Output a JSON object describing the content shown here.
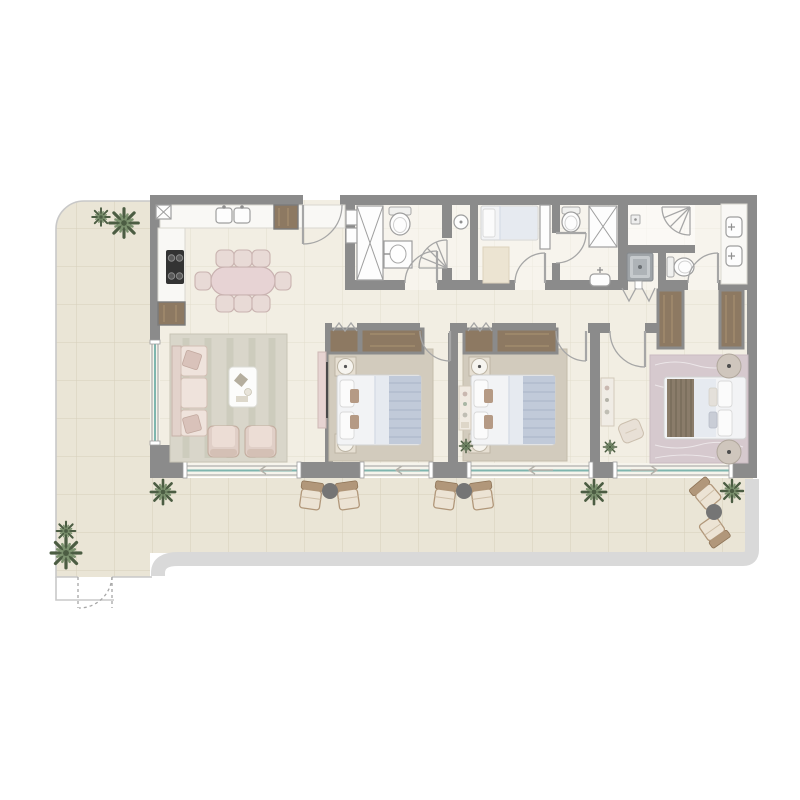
{
  "meta": {
    "title": "apartment-floor-plan",
    "canvas_width": 800,
    "canvas_height": 800
  },
  "palette": {
    "wall": "#8b8b8b",
    "white": "#ffffff",
    "floorIn": "#f2eee3",
    "floorTer": "#eae5d6",
    "gridIn": "rgba(185,175,145,0.28)",
    "gridTer": "rgba(172,162,132,0.32)",
    "band": "#d9d9d9",
    "outline": "#c8c8c8",
    "glass": "#7fb5ae",
    "arcLine": "#a6a6a6",
    "wood": "#8d7962",
    "woodGrain": "#a6906f",
    "woodFrame": "#7c7c7c",
    "fixFill": "#fdfdfd",
    "fixStroke": "#9e9e9e",
    "counter": "#f9f8f5",
    "counterStroke": "#d9d7d0",
    "appliance": "#333333",
    "pinkFill": "#e7d3d4",
    "pinkStroke": "#c9b2b1",
    "chairFill": "#e8dad6",
    "chairStroke": "#c9b3b0",
    "rugLiving": "#d9d6ca",
    "rugBed": "#d2cbbd",
    "rugMaster": "#d6c9ce",
    "mattress": "#f2f3f5",
    "mattressStroke": "#d3d3d3",
    "pillow": "#fbfbfb",
    "duvet": "#e6eaf0",
    "throw": "#c1cad9",
    "throwLine": "#a9b4c6",
    "bedBrown": "#8a7c6a",
    "bedBrownLine": "#6f6353",
    "nstand": "#e6dfd2",
    "nstandStroke": "#bdb5a5",
    "lamp": "#f6f4ef",
    "plantDark": "#4c5d43",
    "plantLight": "#7d9370",
    "outChairWood": "#b1977a",
    "outChairSeat": "#ece3d4",
    "outTable": "#757575",
    "washerA": "#9fa4a8",
    "washerB": "#c6cacd"
  },
  "inventory": {
    "double_beds": 3,
    "single_beds": 1,
    "sofas": 1,
    "armchairs": 2,
    "dining_chairs": 8,
    "toilets": 3,
    "washbasins": 5,
    "showers": 3,
    "washing_machines": 1,
    "wardrobes": 6,
    "plants": 9,
    "outdoor_chairs": 6,
    "outdoor_side_tables": 3,
    "sliding_windows": 5,
    "swing_doors": 9
  }
}
